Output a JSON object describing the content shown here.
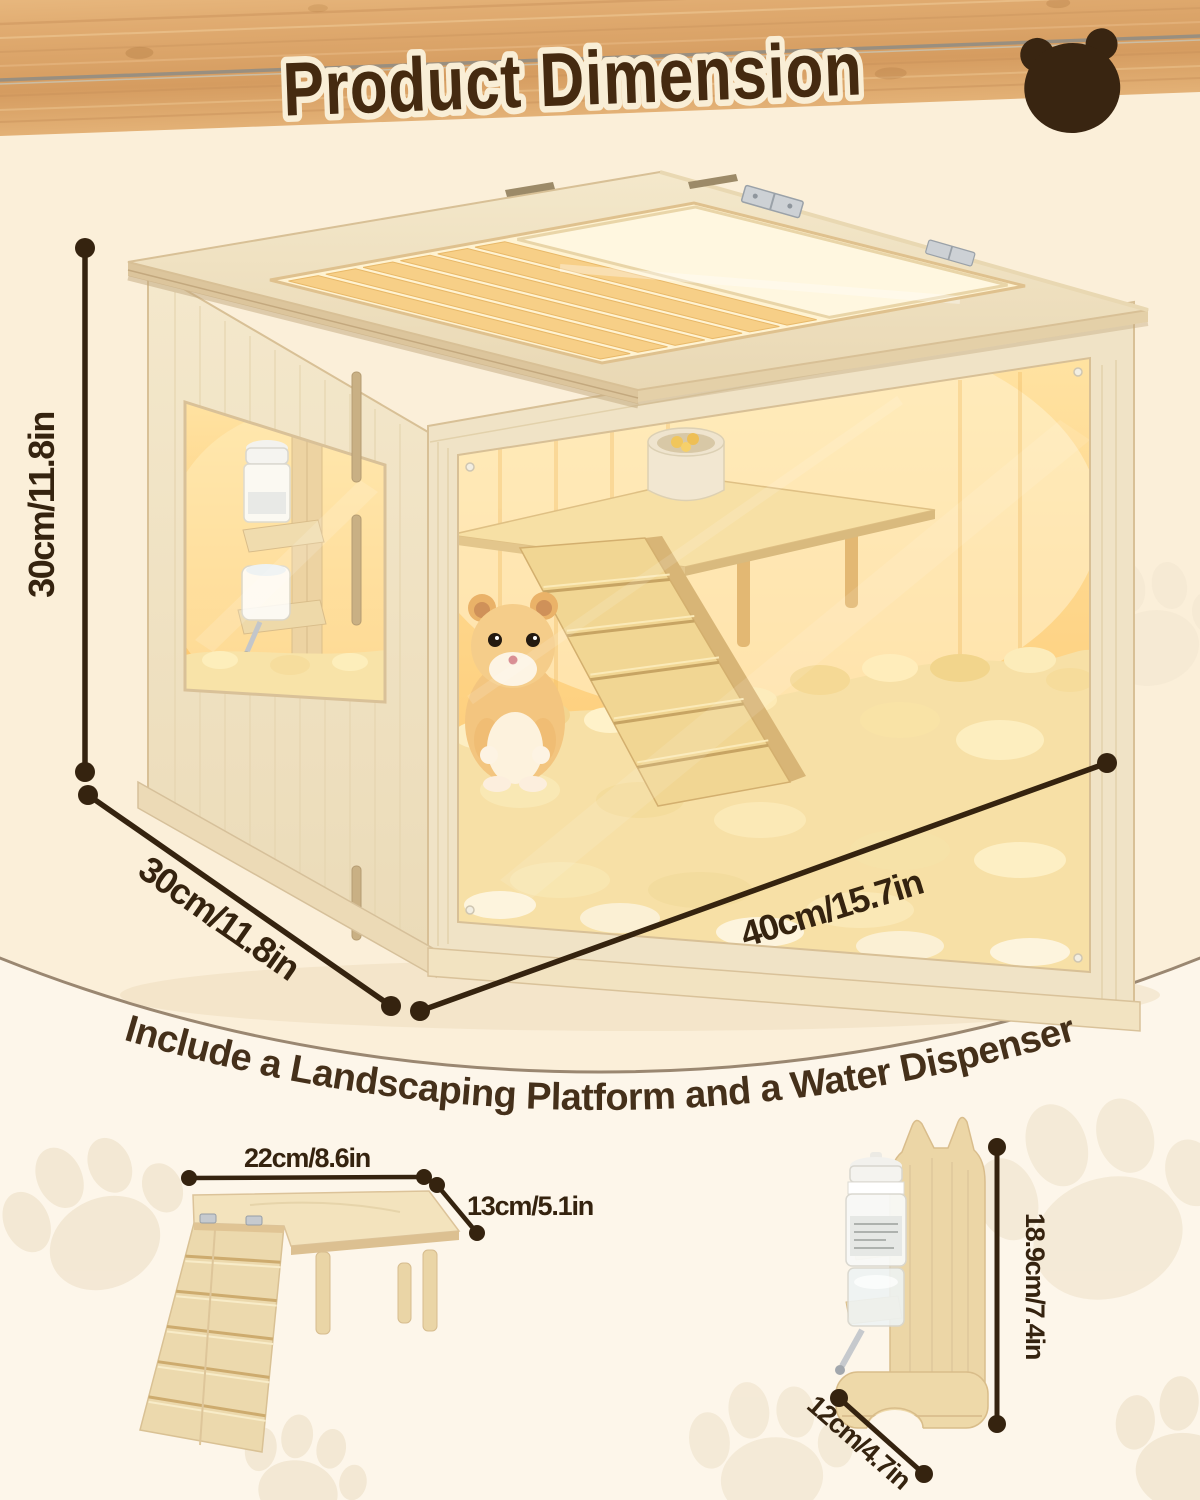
{
  "header": {
    "title": "Product Dimension"
  },
  "caption": "Include a Landscaping Platform and a Water Dispenser",
  "cage": {
    "height": "30cm/11.8in",
    "depth": "30cm/11.8in",
    "width": "40cm/15.7in"
  },
  "platform": {
    "width": "22cm/8.6in",
    "depth": "13cm/5.1in"
  },
  "dispenser": {
    "height": "18.9cm/7.4in",
    "base": "12cm/4.7in"
  },
  "icons": {
    "bear": "bear-icon",
    "paw": "paw-print-icon",
    "hinge": "lid-hinge"
  },
  "colors": {
    "banner_wood": "#dda66b",
    "title_ink": "#452a10",
    "title_outline": "#f9eed6",
    "dimension_ink": "#35230f",
    "upper_bg": "#fbefd9",
    "lower_bg": "#fdf6ea",
    "arc_stroke": "#9a8771",
    "interior_glow": "#ffd98c",
    "wood_light": "#f1e4c7"
  }
}
